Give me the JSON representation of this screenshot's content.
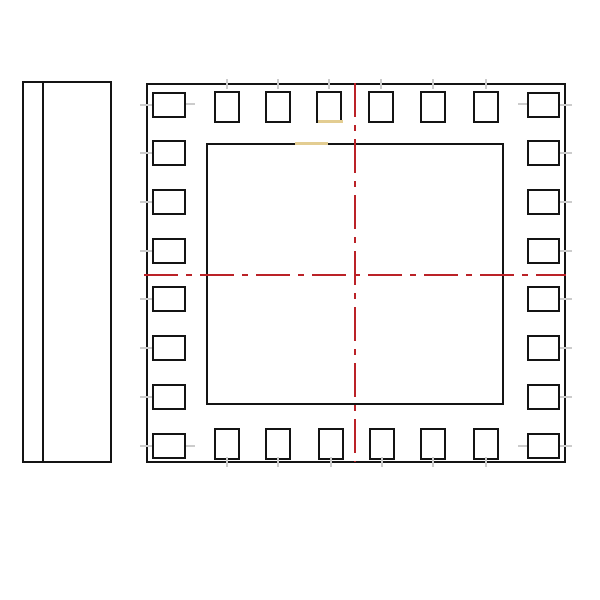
{
  "drawing": {
    "type": "ic-package-technical-drawing",
    "canvas": {
      "w": 600,
      "h": 600,
      "background": "#ffffff"
    },
    "colors": {
      "line": "#141414",
      "pad_fill": "#ffffff",
      "centerline": "#bb2228",
      "highlight": "#e3cd92",
      "tick": "#cccccc"
    },
    "side_view": {
      "outline": {
        "x": 22,
        "y": 81,
        "w": 90,
        "h": 382
      },
      "seam": {
        "x": 42,
        "y": 83,
        "w": 2,
        "h": 378
      }
    },
    "top_view": {
      "outer_outline": {
        "x": 146,
        "y": 83,
        "w": 420,
        "h": 380
      },
      "inner_outline": {
        "x": 206,
        "y": 143,
        "w": 298,
        "h": 262
      }
    },
    "centerlines": {
      "vertical": {
        "x": 354,
        "y": 83,
        "w": 2,
        "h": 379
      },
      "horizontal": {
        "x": 144,
        "y": 274,
        "w": 422,
        "h": 2
      },
      "dash": {
        "long": 34,
        "gap": 8,
        "short": 6
      }
    },
    "pads": {
      "top_row": {
        "y": 91,
        "w": 26,
        "h": 32,
        "xs": [
          214,
          265,
          316,
          368,
          420,
          473
        ]
      },
      "bottom_row": {
        "y": 428,
        "w": 26,
        "h": 32,
        "xs": [
          214,
          265,
          318,
          369,
          420,
          473
        ]
      },
      "left_col": {
        "x": 152,
        "w": 34,
        "h": 26,
        "ys": [
          92,
          140,
          189,
          238,
          286,
          335,
          384,
          433
        ]
      },
      "right_col": {
        "x": 527,
        "w": 33,
        "h": 26,
        "ys": [
          92,
          140,
          189,
          238,
          286,
          335,
          384,
          433
        ]
      }
    },
    "lead_ticks": {
      "side_len": 12,
      "cap_len": 10,
      "thickness": 2,
      "corner_flanks": [
        {
          "x": 186,
          "y": 103,
          "w": 9,
          "h": 2
        },
        {
          "x": 186,
          "y": 445,
          "w": 9,
          "h": 2
        },
        {
          "x": 518,
          "y": 103,
          "w": 9,
          "h": 2
        },
        {
          "x": 518,
          "y": 445,
          "w": 9,
          "h": 2
        }
      ]
    },
    "highlights": [
      {
        "x": 318,
        "y": 120,
        "w": 25,
        "h": 3,
        "note": "pad-bottom-edge-highlight"
      },
      {
        "x": 295,
        "y": 142,
        "w": 33,
        "h": 3,
        "note": "inner-outline-top-edge-highlight"
      }
    ]
  }
}
